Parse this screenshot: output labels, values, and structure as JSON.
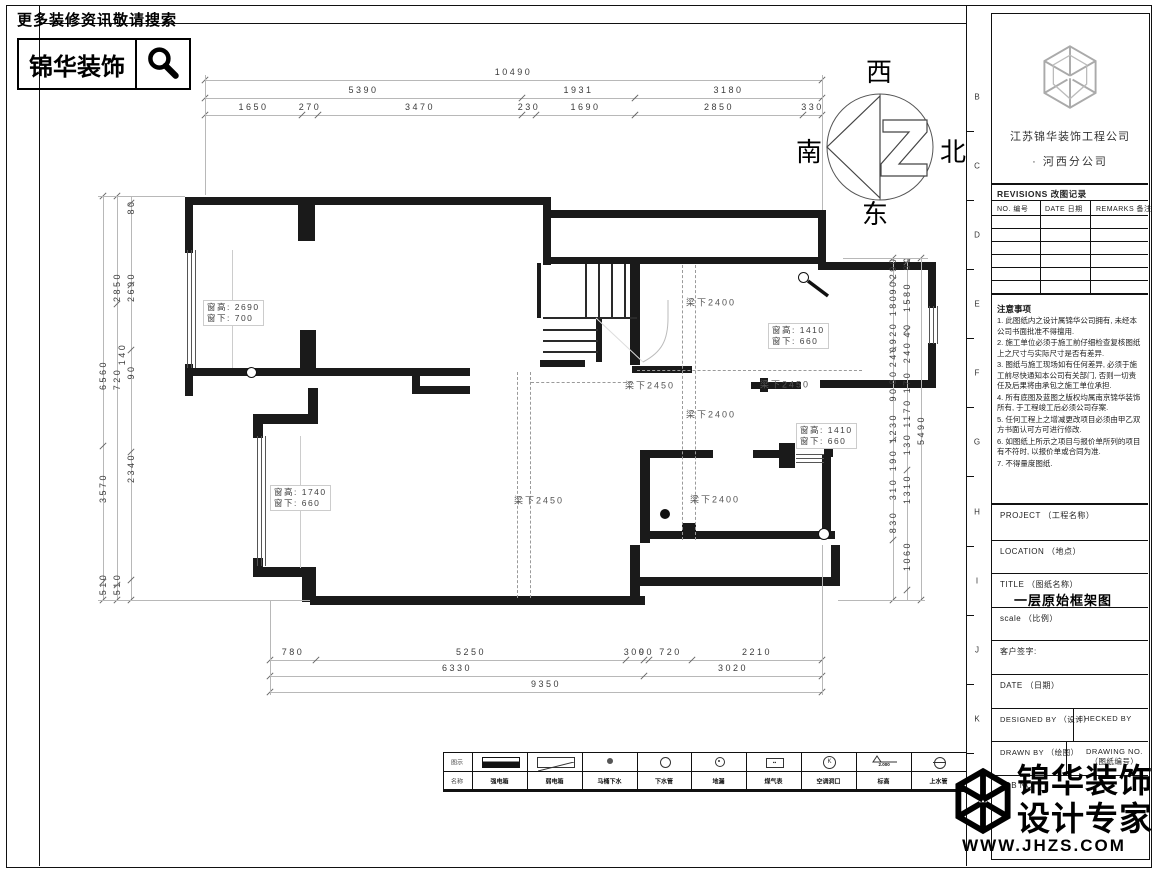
{
  "banner": {
    "tagline": "更多装修资讯敬请搜索",
    "brand": "锦华装饰"
  },
  "compass": {
    "top": "西",
    "right": "北",
    "left": "南",
    "bottom": "东"
  },
  "dims": {
    "top": [
      [
        "10490"
      ],
      [
        "5390",
        "1931",
        "3180"
      ],
      [
        "1650",
        "270",
        "3470",
        "230",
        "1690",
        "2850",
        "330"
      ]
    ],
    "bottom": [
      [
        "780",
        "5250",
        "300",
        "90",
        "720",
        "2210"
      ],
      [
        "6330",
        "3020"
      ],
      [
        "9350"
      ]
    ],
    "left": [
      "6560",
      "3570",
      "510",
      "2850",
      "2690",
      "80",
      "140",
      "720",
      "90",
      "2340",
      "510"
    ],
    "right": [
      "290",
      "90",
      "180",
      "920",
      "240",
      "80",
      "90",
      "1230",
      "190",
      "310",
      "830",
      "80",
      "1580",
      "40",
      "240",
      "170",
      "1170",
      "130",
      "1310",
      "1060",
      "5490"
    ]
  },
  "plan": {
    "beam_labels": [
      "梁下2400",
      "梁下2450",
      "梁下2450",
      "梁下2400",
      "梁下2450",
      "梁下2400"
    ],
    "window_labels": [
      {
        "l1": "窗高: 2690",
        "l2": "窗下: 700"
      },
      {
        "l1": "窗高: 1410",
        "l2": "窗下: 660"
      },
      {
        "l1": "窗高: 1410",
        "l2": "窗下: 660"
      },
      {
        "l1": "窗高: 1740",
        "l2": "窗下: 660"
      }
    ]
  },
  "sheet": {
    "margin_letters": [
      "B",
      "C",
      "D",
      "E",
      "F",
      "G",
      "H",
      "I",
      "J",
      "K"
    ]
  },
  "titleblock": {
    "company": {
      "name": "江苏锦华装饰工程公司",
      "branch": "·  河西分公司"
    },
    "revisions": {
      "title": "REVISIONS  改图记录",
      "cols": [
        "NO.  编号",
        "DATE  日期",
        "REMARKS  备注"
      ]
    },
    "notes": {
      "title": "注意事项",
      "items": [
        "1. 此图纸内之设计属锦华公司拥有, 未经本公司书面批准不得擅用.",
        "2. 施工单位必须于施工前仔细检查复核图纸上之尺寸与实际尺寸是否有差异.",
        "3. 图纸与施工现场如有任何差异, 必须于施工前尽快通知本公司有关部门, 否则一切责任及后果将由承包之施工单位承担.",
        "4. 所有底图及蓝图之版权均属南京锦华装饰所有, 于工程竣工后必须公司存案.",
        "5. 任何工程上之增减更改项目必须由甲乙双方书面认可方可进行修改.",
        "6. 如图纸上所示之项目与报价单所列的项目有不符时, 以报价单或合同为准.",
        "7. 不得量度图纸."
      ]
    },
    "fields": {
      "project": "PROJECT （工程名称）",
      "location": "LOCATION （地点）",
      "title_label": "TITLE （图纸名称）",
      "title_value": "一层原始框架图",
      "scale": "scale  （比例）",
      "customer": "客户签字:",
      "date": "DATE （日期）",
      "designed": "DESIGNED BY （设计）",
      "checked": "CHECKED BY",
      "drawn": "DRAWN BY （绘图）",
      "drawing_no_1": "DRAWING NO.",
      "drawing_no_2": "（图纸编号）",
      "job": "JOB NO."
    }
  },
  "legend": {
    "header_symbol": "图示",
    "header_name": "名称",
    "items": [
      {
        "label": "强电箱",
        "sym": "filled-bar"
      },
      {
        "label": "弱电箱",
        "sym": "diag-rect"
      },
      {
        "label": "马桶下水",
        "sym": "small-filled-circle"
      },
      {
        "label": "下水管",
        "sym": "open-circle"
      },
      {
        "label": "地漏",
        "sym": "circle-dot"
      },
      {
        "label": "煤气表",
        "sym": "meter-box"
      },
      {
        "label": "空调洞口",
        "sym": "circle-k",
        "glyph": "K"
      },
      {
        "label": "标高",
        "sym": "level-mark",
        "note": "2.000"
      },
      {
        "label": "上水管",
        "sym": "circle-dash"
      }
    ]
  },
  "footer_logo": {
    "brand_line1": "锦华装饰",
    "brand_line2": "设计专家",
    "url": "WWW.JHZS.COM"
  }
}
